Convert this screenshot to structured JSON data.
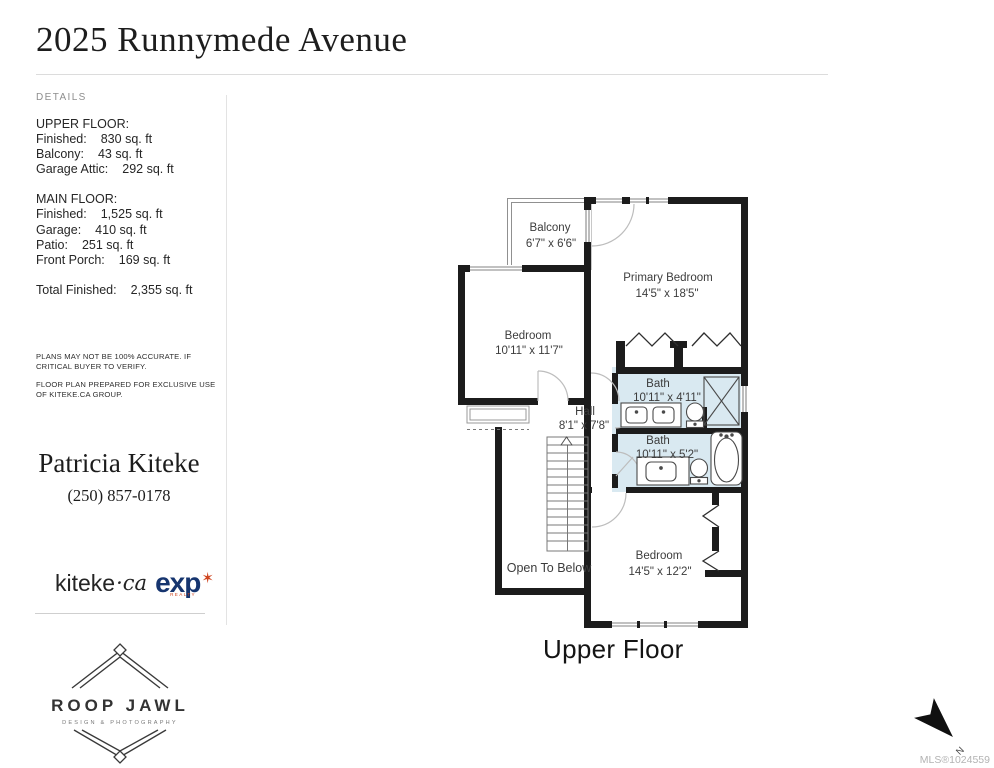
{
  "header": {
    "title": "2025 Runnymede Avenue"
  },
  "sidebar": {
    "section_label": "DETAILS",
    "upper_floor": {
      "heading": "UPPER FLOOR:",
      "rows": [
        {
          "label": "Finished:",
          "value": "830 sq. ft"
        },
        {
          "label": "Balcony:",
          "value": "43 sq. ft"
        },
        {
          "label": "Garage Attic:",
          "value": "292 sq. ft"
        }
      ]
    },
    "main_floor": {
      "heading": "MAIN FLOOR:",
      "rows": [
        {
          "label": "Finished:",
          "value": "1,525 sq. ft"
        },
        {
          "label": "Garage:",
          "value": "410 sq. ft"
        },
        {
          "label": "Patio:",
          "value": "251 sq. ft"
        },
        {
          "label": "Front Porch:",
          "value": "169 sq. ft"
        }
      ]
    },
    "total": {
      "label": "Total Finished:",
      "value": "2,355 sq. ft"
    },
    "disclaimer1": "PLANS MAY NOT BE 100% ACCURATE. IF CRITICAL BUYER TO VERIFY.",
    "disclaimer2": "FLOOR PLAN PREPARED FOR EXCLUSIVE USE OF KITEKE.CA GROUP.",
    "agent_name": "Patricia Kiteke",
    "agent_phone": "(250) 857-0178",
    "brand": {
      "kiteke": "kiteke",
      "dot_ca": "·ca",
      "exp": "exp",
      "exp_star": "✶",
      "exp_realty": "REALTY"
    },
    "photography": {
      "name": "ROOP JAWL",
      "tagline": "DESIGN & PHOTOGRAPHY"
    }
  },
  "plan": {
    "floor_label": "Upper Floor",
    "balcony": {
      "name": "Balcony",
      "dims": "6'7\" x 6'6\""
    },
    "primary_bedroom": {
      "name": "Primary Bedroom",
      "dims": "14'5\" x 18'5\""
    },
    "bedroom_left": {
      "name": "Bedroom",
      "dims": "10'11\" x 11'7\""
    },
    "hall": {
      "name": "Hall",
      "dims": "8'1\" x 7'8\""
    },
    "bath_upper": {
      "name": "Bath",
      "dims": "10'11\" x 4'11\""
    },
    "bath_lower": {
      "name": "Bath",
      "dims": "10'11\" x 5'2\""
    },
    "bedroom_bottom": {
      "name": "Bedroom",
      "dims": "14'5\" x 12'2\""
    },
    "open_to_below": "Open To Below",
    "north": "N"
  },
  "footer": {
    "mls": "MLS®1024559"
  },
  "colors": {
    "wall": "#1c1c1c",
    "bath_fill": "#d9e9f1",
    "exp_navy": "#16356f",
    "accent_red": "#cf4520"
  }
}
